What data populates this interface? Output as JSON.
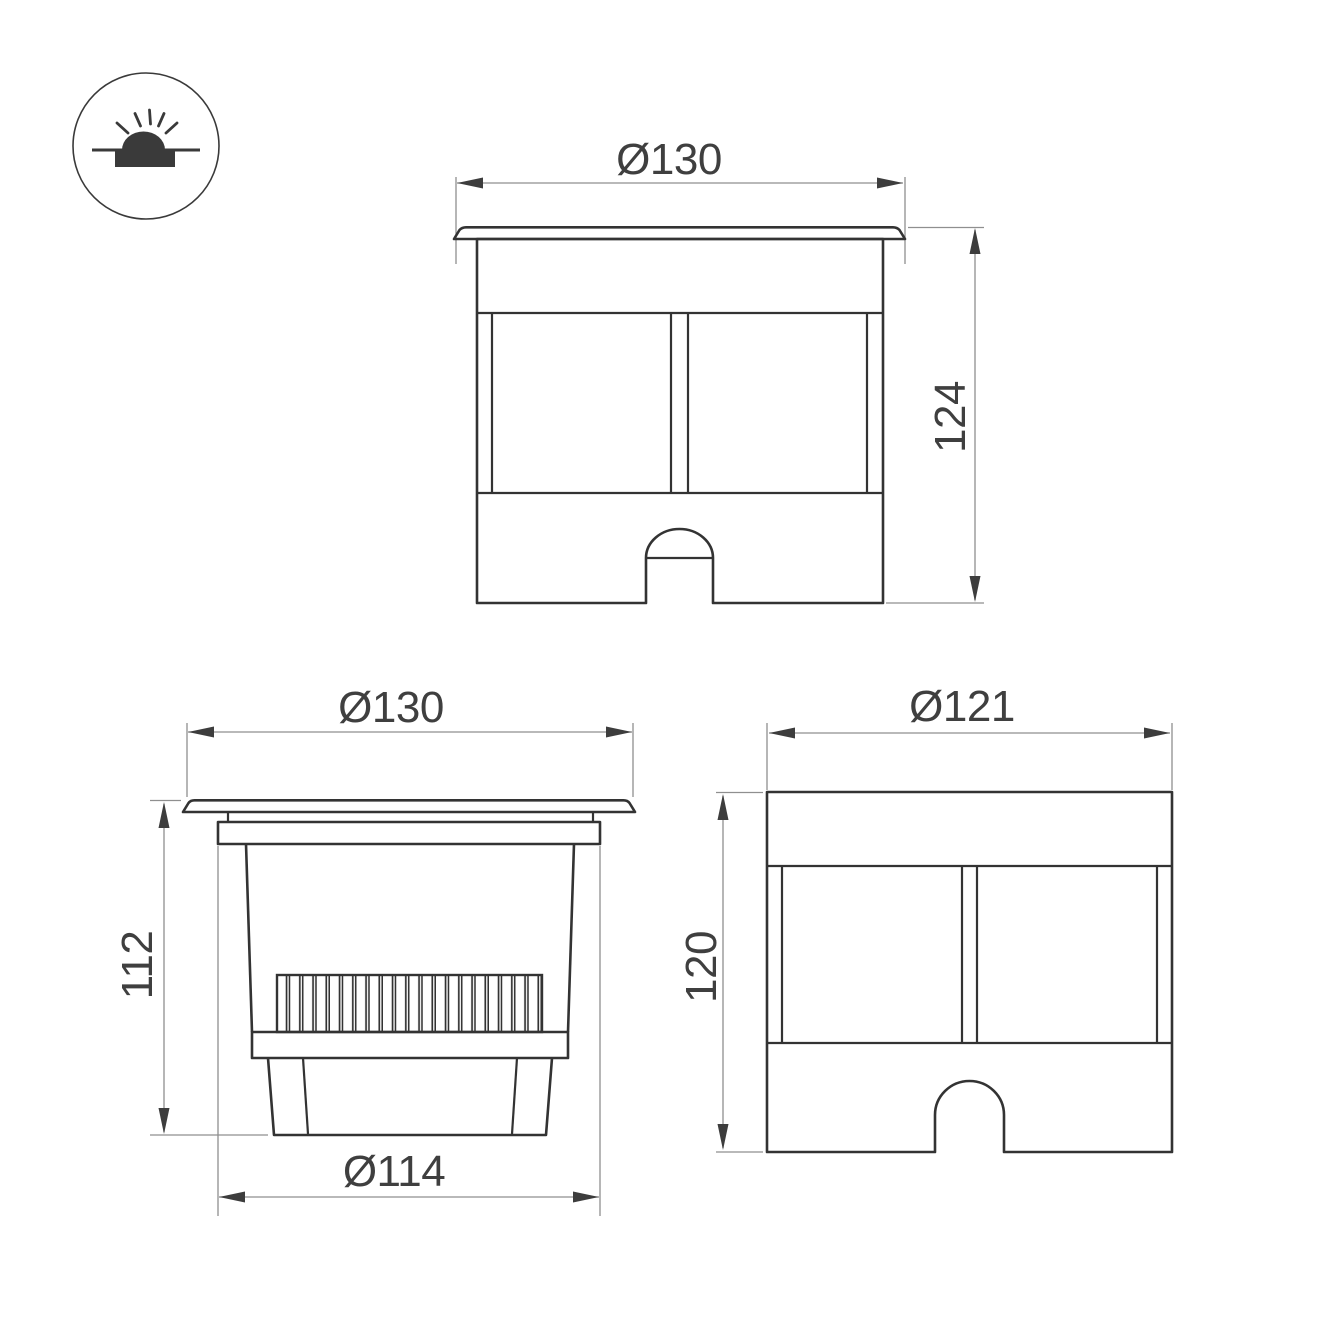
{
  "page": {
    "background": "#ffffff"
  },
  "icon": {
    "name": "recessed-in-ground-luminaire-symbol",
    "color": "#3a3a3a"
  },
  "views": {
    "front_with_flange": {
      "name": "front view with flange",
      "width_dim": "Ø130",
      "height_dim": "124"
    },
    "side_profile": {
      "name": "side view of recessed body",
      "width_dim": "Ø130",
      "height_dim": "112",
      "sleeve_dim": "Ø114"
    },
    "front_without_flange": {
      "name": "front view without flange",
      "width_dim": "Ø121",
      "height_dim": "120"
    }
  },
  "colors": {
    "outline": "#333333",
    "dimension_line": "#8f8f8f",
    "arrowhead": "#3d3d3d",
    "text": "#3f3f3f"
  }
}
